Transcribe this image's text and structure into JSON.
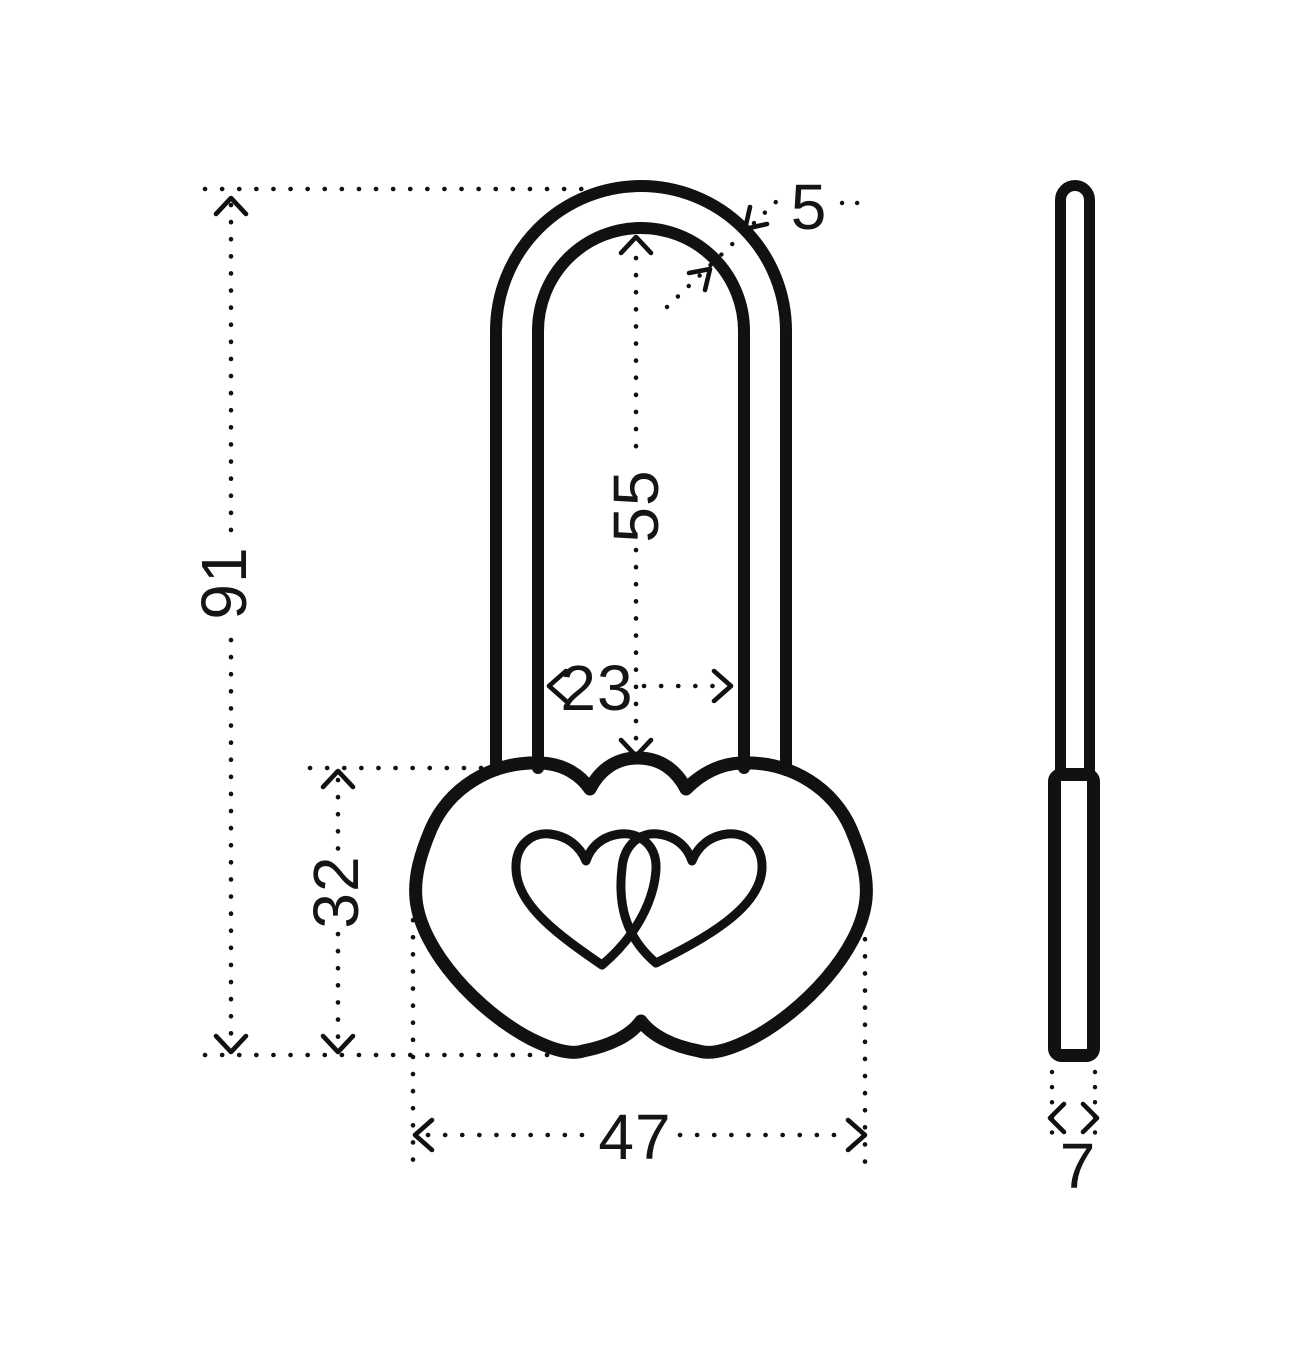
{
  "drawing": {
    "type": "padlock-technical-drawing",
    "dimensions": {
      "overall_height": "91",
      "shackle_inner_height": "55",
      "shackle_inner_width": "23",
      "shackle_wire_diameter": "5",
      "body_height": "32",
      "body_width": "47",
      "body_thickness": "7"
    },
    "colors": {
      "line": "#111111",
      "background": "#ffffff"
    }
  }
}
